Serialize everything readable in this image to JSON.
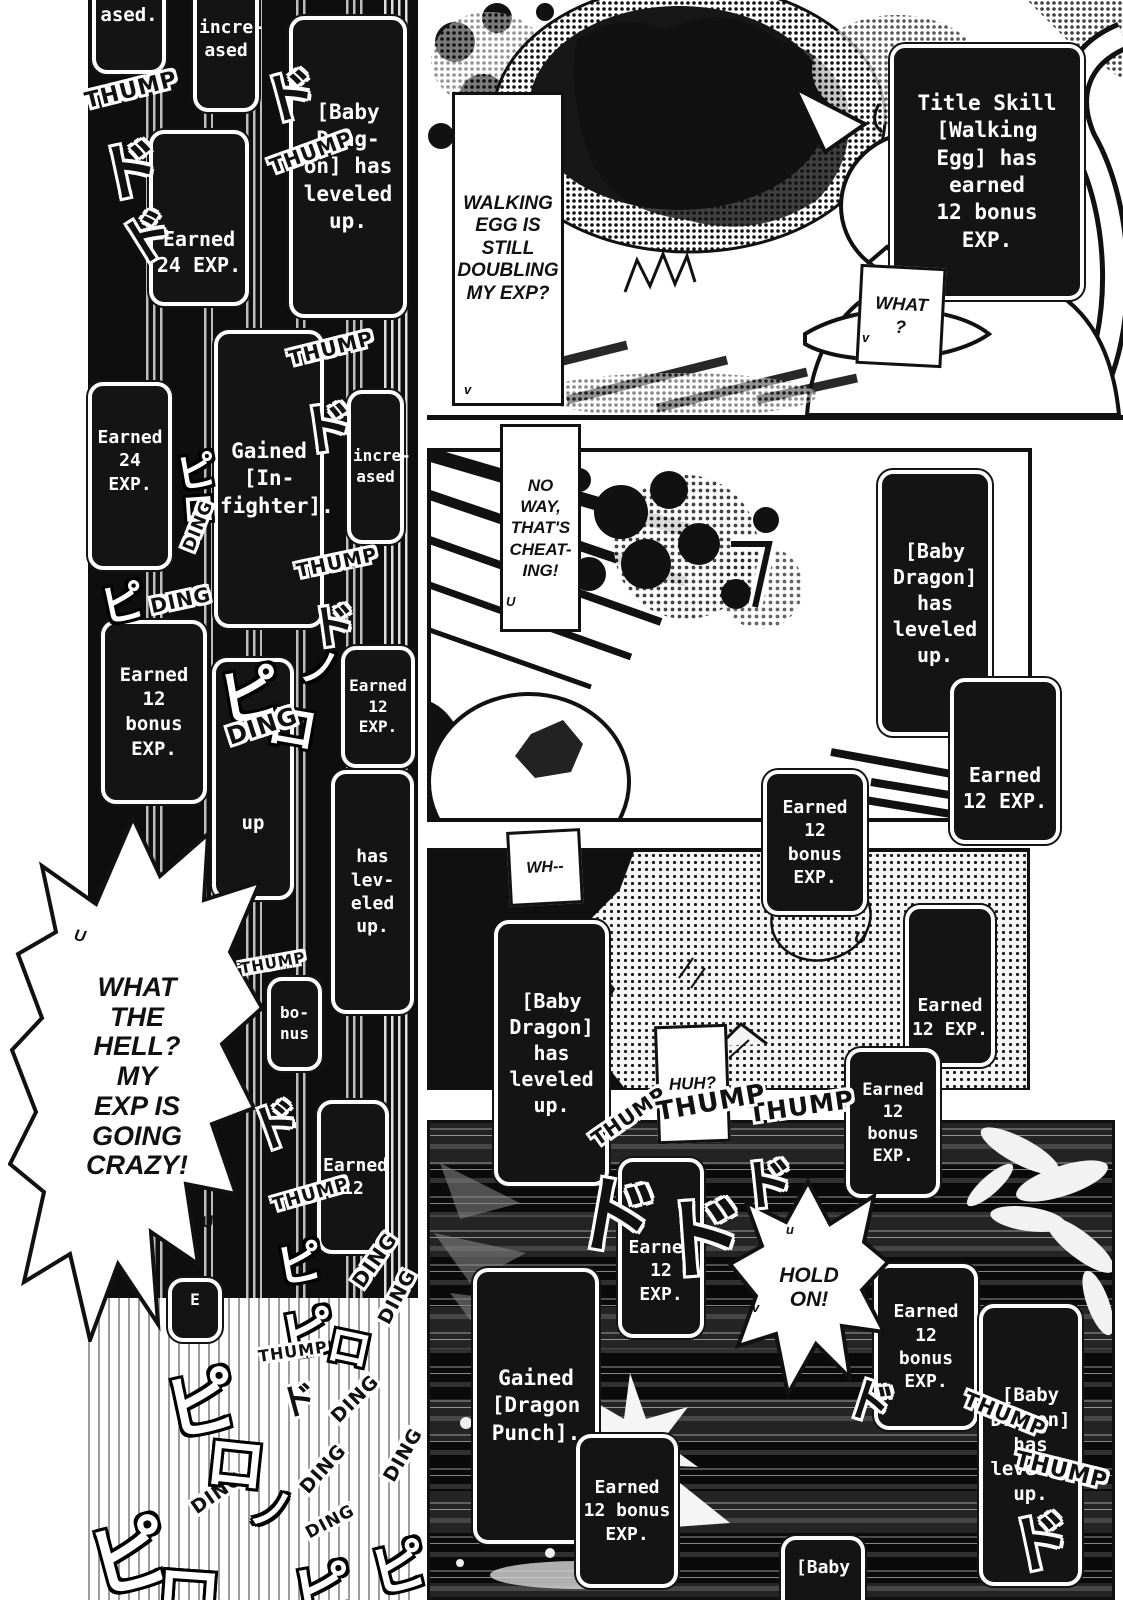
{
  "colors": {
    "ink": "#111111",
    "paper": "#ffffff",
    "box_bg": "#141414",
    "box_border": "#ffffff"
  },
  "bubbles": {
    "walking_egg": {
      "text": "WALKING\nEGG IS\nSTILL\nDOUBLING\nMY EXP?"
    },
    "what": {
      "text": "WHAT\n?"
    },
    "no_way": {
      "text": "NO\nWAY,\nTHAT'S\nCHEAT-\nING!"
    },
    "what_the_hell": {
      "text": "WHAT\nTHE\nHELL?\nMY\nEXP IS\nGOING\nCRAZY!"
    },
    "wh": {
      "text": "WH--"
    },
    "huh": {
      "text": "HUH?"
    },
    "hold_on": {
      "text": "HOLD\nON!"
    }
  },
  "status_boxes": [
    {
      "name": "ased-fragment",
      "text": "ased.",
      "x": 92,
      "y": -44,
      "w": 74,
      "h": 118,
      "fs": 19
    },
    {
      "name": "increased-top",
      "text": "incre-\nased",
      "x": 193,
      "y": -34,
      "w": 66,
      "h": 146,
      "fs": 18
    },
    {
      "name": "baby-dragon-level-1",
      "text": "[Baby\nDrag-\non] has\nleveled\nup.",
      "x": 289,
      "y": 16,
      "w": 118,
      "h": 302,
      "fs": 21
    },
    {
      "name": "earned-24-exp-1",
      "text": "Earned\n24 EXP.",
      "x": 149,
      "y": 130,
      "w": 100,
      "h": 176,
      "fs": 20,
      "align": "end",
      "pad": 24
    },
    {
      "name": "earned-24-exp-2",
      "text": "Earned\n24 EXP.",
      "x": 88,
      "y": 382,
      "w": 84,
      "h": 188,
      "fs": 18,
      "align": "start",
      "pad": 40
    },
    {
      "name": "gained-infighter",
      "text": "Gained\n[In-\nfighter].",
      "x": 214,
      "y": 330,
      "w": 110,
      "h": 298,
      "fs": 21
    },
    {
      "name": "increased-2",
      "text": "incre-\nased",
      "x": 347,
      "y": 390,
      "w": 57,
      "h": 154,
      "fs": 16
    },
    {
      "name": "earned-12-bonus-left",
      "text": "Earned\n12\nbonus\nEXP.",
      "x": 101,
      "y": 620,
      "w": 106,
      "h": 184,
      "fs": 19
    },
    {
      "name": "up-fragment",
      "text": "up",
      "x": 212,
      "y": 658,
      "w": 82,
      "h": 242,
      "fs": 19,
      "align": "end",
      "pad": 60
    },
    {
      "name": "earned-12-exp-left",
      "text": "Earned\n12 EXP.",
      "x": 341,
      "y": 646,
      "w": 74,
      "h": 122,
      "fs": 16
    },
    {
      "name": "has-leveled-fragment",
      "text": "has\nlev-\neled\nup.",
      "x": 331,
      "y": 770,
      "w": 83,
      "h": 244,
      "fs": 18
    },
    {
      "name": "bonus-fragment",
      "text": "bo-\nnus",
      "x": 267,
      "y": 977,
      "w": 55,
      "h": 94,
      "fs": 16
    },
    {
      "name": "earned-12-fragment",
      "text": "Earned\n12",
      "x": 317,
      "y": 1100,
      "w": 72,
      "h": 154,
      "fs": 18
    },
    {
      "name": "e-fragment",
      "text": "E",
      "x": 168,
      "y": 1278,
      "w": 54,
      "h": 64,
      "fs": 16,
      "align": "start",
      "pad": 8
    },
    {
      "name": "title-skill-walking-egg",
      "text": "Title Skill\n[Walking\nEgg] has\nearned\n12 bonus\nEXP.",
      "x": 890,
      "y": 44,
      "w": 194,
      "h": 256,
      "fs": 21
    },
    {
      "name": "baby-dragon-level-2",
      "text": "[Baby\nDragon]\nhas\nleveled\nup.",
      "x": 878,
      "y": 470,
      "w": 114,
      "h": 266,
      "fs": 20
    },
    {
      "name": "earned-12-exp-p2",
      "text": "Earned\n12 EXP.",
      "x": 950,
      "y": 678,
      "w": 110,
      "h": 166,
      "fs": 20,
      "align": "end",
      "pad": 26
    },
    {
      "name": "earned-12-bonus-p2",
      "text": "Earned\n12\nbonus\nEXP.",
      "x": 763,
      "y": 770,
      "w": 104,
      "h": 145,
      "fs": 18
    },
    {
      "name": "baby-dragon-level-3",
      "text": "[Baby\nDragon]\nhas\nleveled\nup.",
      "x": 494,
      "y": 920,
      "w": 115,
      "h": 266,
      "fs": 20
    },
    {
      "name": "earned-12-exp-p3",
      "text": "Earned\n12 EXP.",
      "x": 905,
      "y": 905,
      "w": 90,
      "h": 162,
      "fs": 18,
      "align": "end",
      "pad": 22
    },
    {
      "name": "earned-12-bonus-p3",
      "text": "Earned\n12\nbonus\nEXP.",
      "x": 846,
      "y": 1048,
      "w": 94,
      "h": 150,
      "fs": 17
    },
    {
      "name": "earned-12-exp-p4",
      "text": "Earned\n12 EXP.",
      "x": 618,
      "y": 1158,
      "w": 86,
      "h": 180,
      "fs": 18,
      "align": "end",
      "pad": 28
    },
    {
      "name": "earned-12-bonus-p4a",
      "text": "Earned\n12\nbonus\nEXP.",
      "x": 874,
      "y": 1264,
      "w": 104,
      "h": 166,
      "fs": 18
    },
    {
      "name": "baby-dragon-level-4",
      "text": "[Baby\nDragon]\nhas\nleveled\nup.",
      "x": 979,
      "y": 1304,
      "w": 103,
      "h": 282,
      "fs": 19
    },
    {
      "name": "gained-dragon-punch",
      "text": "Gained\n[Dragon\nPunch].",
      "x": 473,
      "y": 1268,
      "w": 126,
      "h": 276,
      "fs": 21
    },
    {
      "name": "earned-12-bonus-p4b",
      "text": "Earned\n12 bonus\nEXP.",
      "x": 576,
      "y": 1434,
      "w": 102,
      "h": 154,
      "fs": 18
    },
    {
      "name": "baby-fragment",
      "text": "[Baby",
      "x": 781,
      "y": 1536,
      "w": 84,
      "h": 84,
      "fs": 18,
      "align": "start",
      "pad": 16
    }
  ],
  "sfx": [
    {
      "name": "thump-1",
      "text": "THUMP",
      "x": 84,
      "y": 78,
      "fs": 22,
      "rot": -14,
      "style": "ink"
    },
    {
      "name": "do-1",
      "text": "ド",
      "x": 98,
      "y": 120,
      "fs": 62,
      "rot": -12,
      "style": "ink"
    },
    {
      "name": "do-2",
      "text": "ド",
      "x": 120,
      "y": 196,
      "fs": 52,
      "rot": -32,
      "style": "ink"
    },
    {
      "name": "do-3",
      "text": "ド",
      "x": 262,
      "y": 52,
      "fs": 54,
      "rot": -15,
      "style": "ink"
    },
    {
      "name": "thump-2",
      "text": "THUMP",
      "x": 268,
      "y": 140,
      "fs": 20,
      "rot": -20,
      "style": "ink"
    },
    {
      "name": "thump-3",
      "text": "THUMP",
      "x": 288,
      "y": 336,
      "fs": 20,
      "rot": -14,
      "style": "ink"
    },
    {
      "name": "do-4",
      "text": "ド",
      "x": 300,
      "y": 384,
      "fs": 54,
      "rot": -8,
      "style": "ink"
    },
    {
      "name": "pi-1",
      "text": "ピ",
      "x": 176,
      "y": 440,
      "fs": 40,
      "rot": -10,
      "style": "paper"
    },
    {
      "name": "ro-1",
      "text": "ロ",
      "x": 182,
      "y": 482,
      "fs": 33,
      "rot": -4,
      "style": "paper"
    },
    {
      "name": "ding-1",
      "text": "DING",
      "x": 172,
      "y": 516,
      "fs": 17,
      "rot": -68,
      "style": "ink"
    },
    {
      "name": "pi-2",
      "text": "ピ",
      "x": 100,
      "y": 568,
      "fs": 44,
      "rot": -12,
      "style": "paper"
    },
    {
      "name": "ding-2",
      "text": "DING",
      "x": 150,
      "y": 588,
      "fs": 20,
      "rot": -12,
      "style": "ink"
    },
    {
      "name": "thump-4",
      "text": "THUMP",
      "x": 296,
      "y": 552,
      "fs": 19,
      "rot": -12,
      "style": "ink"
    },
    {
      "name": "do-5",
      "text": "ド",
      "x": 310,
      "y": 590,
      "fs": 46,
      "rot": -8,
      "style": "ink"
    },
    {
      "name": "pi-3",
      "text": "ピ",
      "x": 218,
      "y": 646,
      "fs": 62,
      "rot": -10,
      "style": "paper"
    },
    {
      "name": "ro-2",
      "text": "ロ",
      "x": 268,
      "y": 688,
      "fs": 50,
      "rot": 10,
      "style": "paper"
    },
    {
      "name": "no-1",
      "text": "ノ",
      "x": 300,
      "y": 636,
      "fs": 40,
      "rot": 8,
      "style": "paper"
    },
    {
      "name": "ding-3",
      "text": "DING",
      "x": 226,
      "y": 712,
      "fs": 24,
      "rot": -18,
      "style": "ink"
    },
    {
      "name": "thump-5",
      "text": "THUMP",
      "x": 240,
      "y": 954,
      "fs": 15,
      "rot": -10,
      "style": "ink"
    },
    {
      "name": "do-6",
      "text": "ド",
      "x": 250,
      "y": 1086,
      "fs": 50,
      "rot": -20,
      "style": "ink"
    },
    {
      "name": "thump-6",
      "text": "THUMP",
      "x": 272,
      "y": 1184,
      "fs": 18,
      "rot": -16,
      "style": "ink"
    },
    {
      "name": "pi-4",
      "text": "ピ",
      "x": 276,
      "y": 1228,
      "fs": 46,
      "rot": -10,
      "style": "paper"
    },
    {
      "name": "ding-4",
      "text": "DING",
      "x": 344,
      "y": 1248,
      "fs": 20,
      "rot": -55,
      "style": "ink"
    },
    {
      "name": "ding-5",
      "text": "DING",
      "x": 368,
      "y": 1286,
      "fs": 19,
      "rot": -62,
      "style": "ink"
    },
    {
      "name": "pi-5",
      "text": "ピ",
      "x": 280,
      "y": 1290,
      "fs": 54,
      "rot": -10,
      "style": "paper"
    },
    {
      "name": "ro-3",
      "text": "ロ",
      "x": 328,
      "y": 1312,
      "fs": 44,
      "rot": 12,
      "style": "paper"
    },
    {
      "name": "thump-7",
      "text": "THUMP",
      "x": 258,
      "y": 1342,
      "fs": 16,
      "rot": -8,
      "style": "ink"
    },
    {
      "name": "do-7",
      "text": "ド",
      "x": 280,
      "y": 1372,
      "fs": 36,
      "rot": -15,
      "style": "ink"
    },
    {
      "name": "ding-6",
      "text": "DING",
      "x": 326,
      "y": 1388,
      "fs": 19,
      "rot": -45,
      "style": "ink"
    },
    {
      "name": "ding-7",
      "text": "DING",
      "x": 374,
      "y": 1444,
      "fs": 19,
      "rot": -60,
      "style": "ink"
    },
    {
      "name": "ding-8",
      "text": "DING",
      "x": 294,
      "y": 1458,
      "fs": 19,
      "rot": -48,
      "style": "ink"
    },
    {
      "name": "ding-9",
      "text": "DING",
      "x": 188,
      "y": 1482,
      "fs": 19,
      "rot": -35,
      "style": "ink"
    },
    {
      "name": "ding-10",
      "text": "DING",
      "x": 304,
      "y": 1512,
      "fs": 17,
      "rot": -28,
      "style": "ink"
    },
    {
      "name": "pi-6",
      "text": "ピ",
      "x": 164,
      "y": 1346,
      "fs": 72,
      "rot": -12,
      "style": "paper"
    },
    {
      "name": "ro-4",
      "text": "ロ",
      "x": 206,
      "y": 1416,
      "fs": 60,
      "rot": 6,
      "style": "paper"
    },
    {
      "name": "no-2",
      "text": "ノ",
      "x": 250,
      "y": 1474,
      "fs": 44,
      "rot": 10,
      "style": "paper"
    },
    {
      "name": "pi-7",
      "text": "ピ",
      "x": 88,
      "y": 1494,
      "fs": 80,
      "rot": -15,
      "style": "paper"
    },
    {
      "name": "ro-5",
      "text": "ロ",
      "x": 156,
      "y": 1542,
      "fs": 66,
      "rot": 4,
      "style": "paper"
    },
    {
      "name": "pi-8",
      "text": "ピ",
      "x": 292,
      "y": 1544,
      "fs": 60,
      "rot": -10,
      "style": "paper"
    },
    {
      "name": "pi-9",
      "text": "ピ",
      "x": 370,
      "y": 1524,
      "fs": 56,
      "rot": -14,
      "style": "paper"
    },
    {
      "name": "thump-8",
      "text": "THUMP",
      "x": 748,
      "y": 1092,
      "fs": 25,
      "rot": -8,
      "style": "ink"
    },
    {
      "name": "do-8",
      "text": "ド",
      "x": 740,
      "y": 1140,
      "fs": 54,
      "rot": -6,
      "style": "ink"
    },
    {
      "name": "thump-9",
      "text": "THUMP",
      "x": 586,
      "y": 1104,
      "fs": 20,
      "rot": -35,
      "style": "ink"
    },
    {
      "name": "thump-10",
      "text": "THUMP",
      "x": 656,
      "y": 1088,
      "fs": 26,
      "rot": -10,
      "style": "ink"
    },
    {
      "name": "do-9",
      "text": "ド",
      "x": 574,
      "y": 1150,
      "fs": 84,
      "rot": 10,
      "style": "ink"
    },
    {
      "name": "do-10",
      "text": "ド",
      "x": 658,
      "y": 1168,
      "fs": 88,
      "rot": -4,
      "style": "ink"
    },
    {
      "name": "thump-11",
      "text": "THUMP",
      "x": 962,
      "y": 1402,
      "fs": 20,
      "rot": 22,
      "style": "ink"
    },
    {
      "name": "thump-12",
      "text": "THUMP",
      "x": 1014,
      "y": 1458,
      "fs": 22,
      "rot": 14,
      "style": "ink"
    },
    {
      "name": "do-11",
      "text": "ド",
      "x": 1008,
      "y": 1492,
      "fs": 62,
      "rot": -12,
      "style": "ink"
    },
    {
      "name": "do-12",
      "text": "ド",
      "x": 848,
      "y": 1366,
      "fs": 46,
      "rot": 18,
      "style": "ink"
    }
  ],
  "marks": [
    {
      "name": "tick-u-1",
      "text": "U",
      "x": 74,
      "y": 928,
      "fs": 16,
      "rot": 10
    },
    {
      "name": "tick-u-2",
      "text": "U",
      "x": 202,
      "y": 1214,
      "fs": 16,
      "rot": -8
    },
    {
      "name": "tick-v-1",
      "text": "v",
      "x": 464,
      "y": 382,
      "fs": 13,
      "rot": 0
    },
    {
      "name": "tick-v-2",
      "text": "v",
      "x": 862,
      "y": 330,
      "fs": 13,
      "rot": 0
    },
    {
      "name": "tick-u-3",
      "text": "U",
      "x": 506,
      "y": 594,
      "fs": 13,
      "rot": 0
    },
    {
      "name": "tick-u-4",
      "text": "U",
      "x": 854,
      "y": 930,
      "fs": 16,
      "rot": 12
    },
    {
      "name": "tick-u-5",
      "text": "u",
      "x": 786,
      "y": 1222,
      "fs": 13,
      "rot": 0
    },
    {
      "name": "tick-v-3",
      "text": "v",
      "x": 752,
      "y": 1300,
      "fs": 13,
      "rot": 0
    }
  ]
}
